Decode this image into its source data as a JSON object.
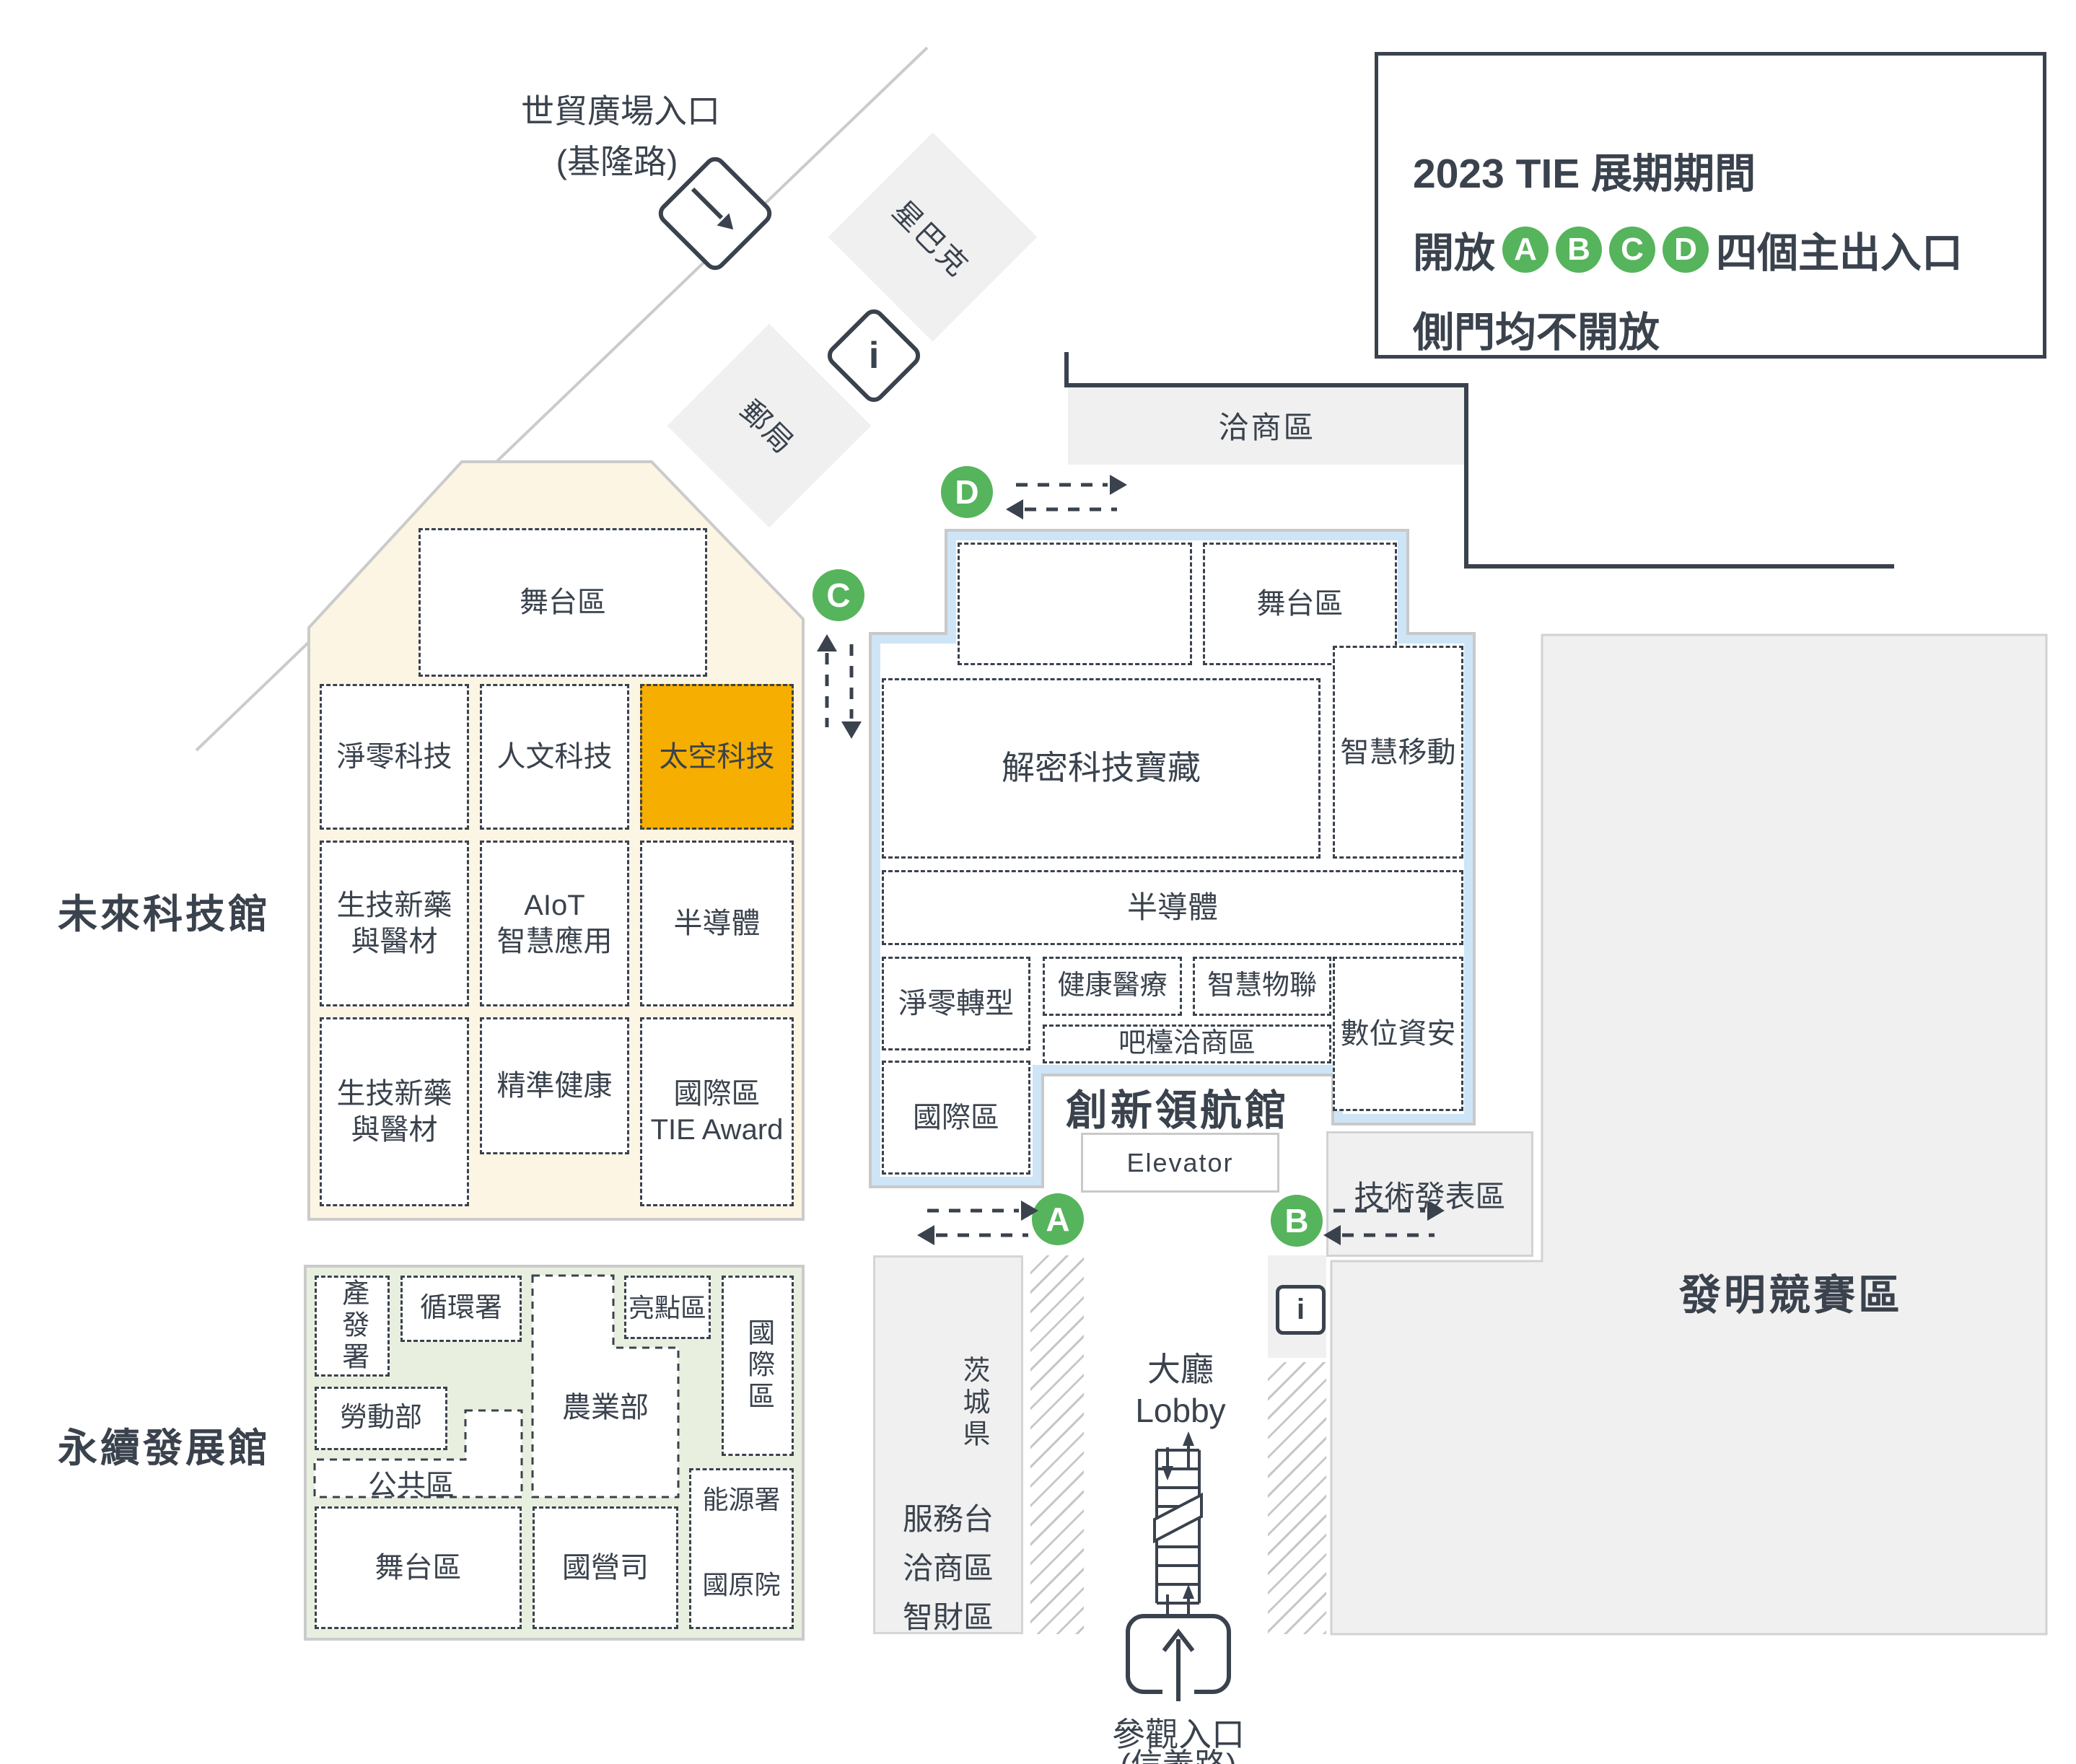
{
  "legend": {
    "line1": "2023 TIE 展期期間",
    "open_prefix": "開放",
    "open_suffix": "四個主出入口",
    "line3": "側門均不開放"
  },
  "entrance_labels": {
    "a": "A",
    "b": "B",
    "c": "C",
    "d": "D"
  },
  "north_entrance": {
    "line1": "世貿廣場入口",
    "line2": "(基隆路)"
  },
  "visitor_entrance": {
    "line1": "參觀入口",
    "line2": "(信義路)"
  },
  "landmarks": {
    "starbucks": "星巴克",
    "post_office": "郵局",
    "info": "i"
  },
  "negotiation_area": "洽商區",
  "invention_area": "發明競賽區",
  "tech_presentation": "技術發表區",
  "lobby": {
    "line1": "大廳",
    "line2": "Lobby"
  },
  "service_area": {
    "line1": "服務台",
    "line2": "洽商區",
    "line3": "智財區",
    "ibaraki": "茨城県"
  },
  "future_tech_hall": {
    "name": "未來科技館",
    "rooms": {
      "stage": "舞台區",
      "net_zero_tech": "淨零科技",
      "humanities_tech": "人文科技",
      "space_tech": "太空科技",
      "biotech_1": "生技新藥\n與醫材",
      "aiot": "AIoT\n智慧應用",
      "semiconductor": "半導體",
      "biotech_2": "生技新藥\n與醫材",
      "precision_health": "精準健康",
      "intl_tie": "國際區\nTIE Award"
    }
  },
  "innovation_hall": {
    "name": "創新領航館",
    "elevator": "Elevator",
    "rooms": {
      "stage": "舞台區",
      "treasure": "解密科技寶藏",
      "smart_mobility": "智慧移動",
      "semiconductor": "半導體",
      "net_zero_transform": "淨零轉型",
      "health_medical": "健康醫療",
      "smart_iot": "智慧物聯",
      "digital_security": "數位資安",
      "bar_area": "吧檯洽商區",
      "intl": "國際區"
    }
  },
  "sustainable_hall": {
    "name": "永續發展館",
    "rooms": {
      "industry": "產發署",
      "circular": "循環署",
      "labor": "勞動部",
      "public": "公共區",
      "stage": "舞台區",
      "agriculture": "農業部",
      "highlight": "亮點區",
      "intl": "國際區",
      "energy": "能源署",
      "atomic": "國原院",
      "state_owned": "國營司"
    }
  }
}
